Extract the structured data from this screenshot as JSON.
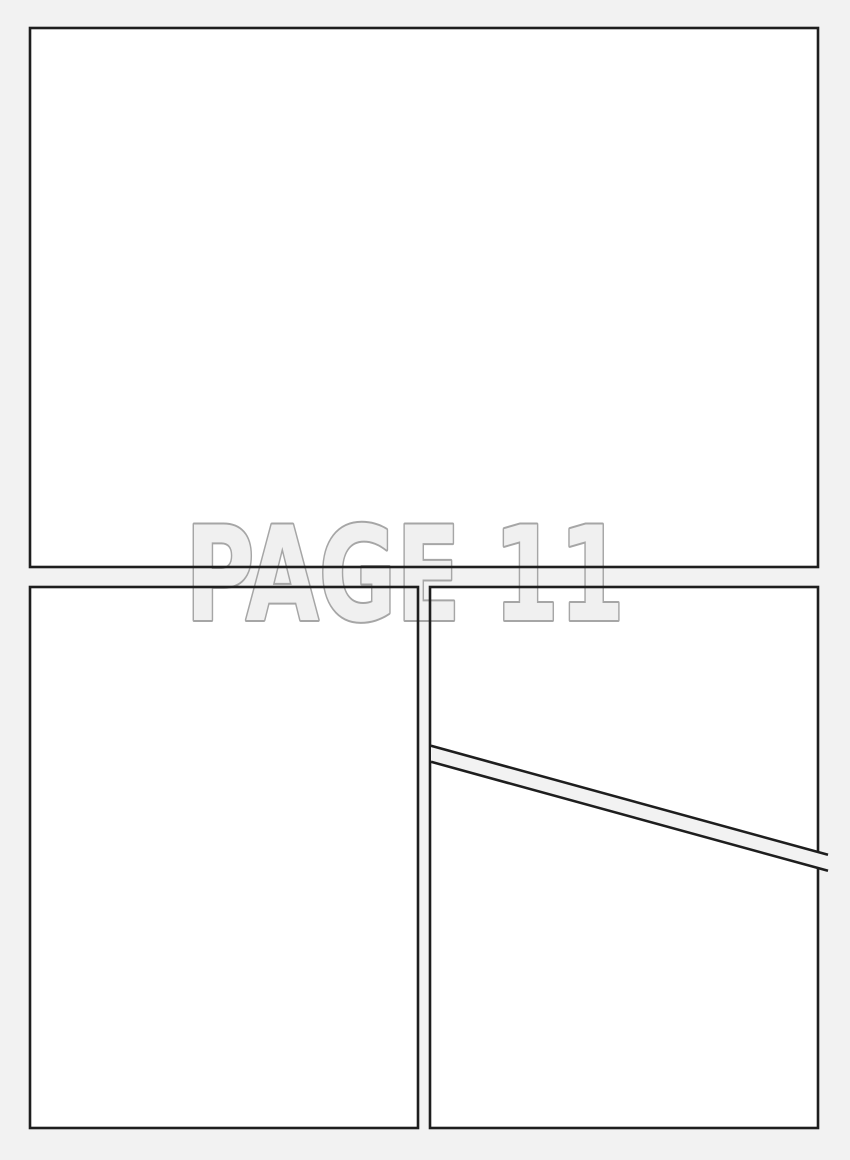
{
  "page": {
    "label": "PAGE 11",
    "colors": {
      "background": "#f2f2f2",
      "panel_fill": "#ffffff",
      "panel_border": "#1e1e1e",
      "watermark_fill": "#f0f0f0",
      "watermark_outline": "#a6a6a6"
    }
  }
}
